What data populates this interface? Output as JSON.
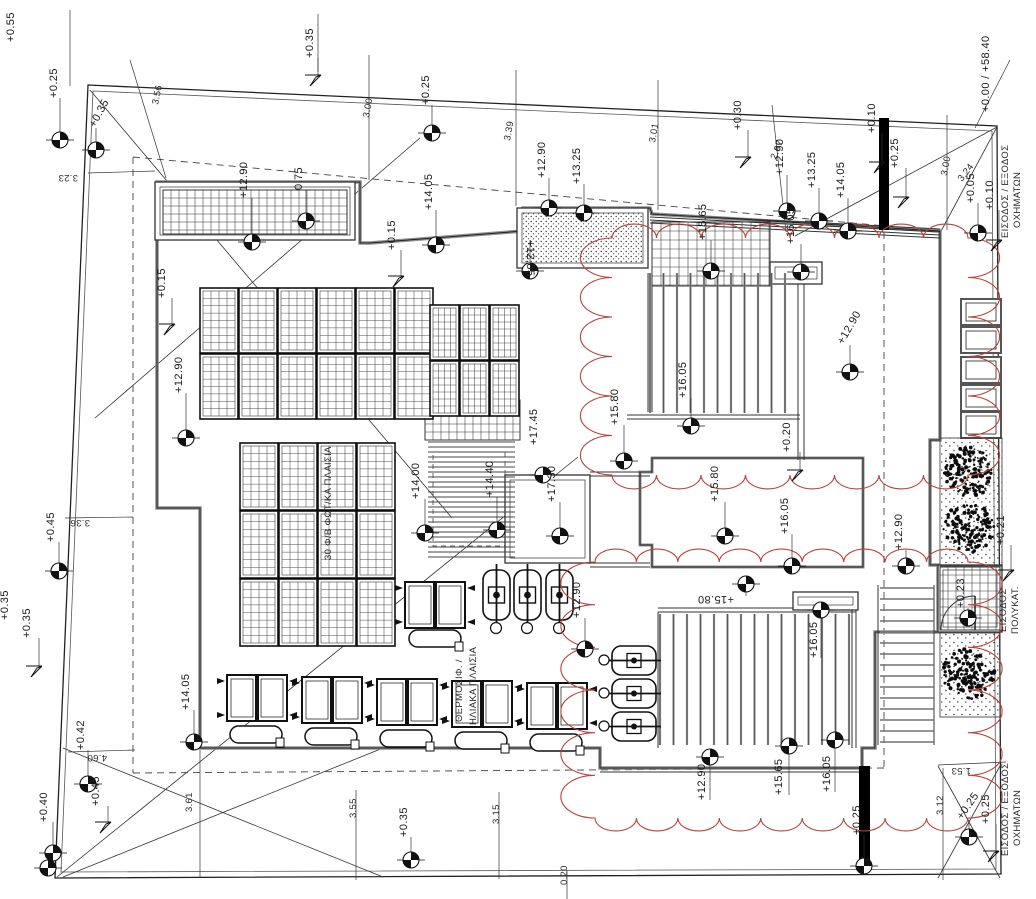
{
  "drawing": {
    "title": "roof plan with photovoltaic and solar heater layout",
    "width": 1036,
    "height": 899
  },
  "colors": {
    "line": "#222222",
    "wall": "#8f8f8f",
    "cloud_red": "#b5433b",
    "black_wall": "#000000",
    "dash": "#444444"
  },
  "boundary": {
    "outer": [
      [
        88,
        85
      ],
      [
        997,
        126
      ],
      [
        1001,
        874
      ],
      [
        55,
        878
      ]
    ],
    "inner": [
      [
        93,
        91
      ],
      [
        992,
        131
      ],
      [
        996,
        869
      ],
      [
        61,
        872
      ]
    ]
  },
  "corner_diagonals": [
    [
      90,
      90,
      452,
      518
    ],
    [
      95,
      418,
      420,
      138
    ],
    [
      63,
      748,
      383,
      877
    ],
    [
      63,
      877,
      383,
      748
    ],
    [
      57,
      877,
      578,
      457
    ],
    [
      938,
      766,
      1000,
      878
    ],
    [
      938,
      878,
      1000,
      766
    ],
    [
      997,
      127,
      940,
      233
    ],
    [
      997,
      127,
      795,
      236
    ]
  ],
  "dashed_segs": [
    [
      133,
      157,
      940,
      231
    ],
    [
      133,
      157,
      133,
      773
    ],
    [
      133,
      773,
      884,
      768
    ],
    [
      884,
      232,
      884,
      768
    ]
  ],
  "dashed_rects": [
    [
      433,
      452,
      72,
      94
    ]
  ],
  "dim_lines": [
    [
      130,
      60,
      166,
      178
    ],
    [
      369,
      55,
      369,
      180
    ],
    [
      516,
      70,
      516,
      206
    ],
    [
      658,
      80,
      658,
      210
    ],
    [
      772,
      105,
      786,
      232
    ],
    [
      947,
      115,
      947,
      230
    ],
    [
      88,
      173,
      155,
      171
    ],
    [
      65,
      518,
      133,
      517
    ],
    [
      68,
      752,
      135,
      750
    ],
    [
      200,
      750,
      200,
      878
    ],
    [
      356,
      790,
      356,
      880
    ],
    [
      499,
      792,
      499,
      879
    ],
    [
      567,
      870,
      567,
      899
    ],
    [
      943,
      768,
      943,
      880
    ],
    [
      938,
      765,
      1006,
      762
    ],
    [
      975,
      128,
      1010,
      60
    ],
    [
      318,
      14,
      318,
      72
    ],
    [
      70,
      10,
      70,
      86
    ]
  ],
  "building_path": "M157,182 L360,182 L360,243 L370,243 L523,231 L523,208 L650,208 L652,214 L940,231 L940,440 L930,440 L930,565 L938,565 L938,632 L875,632 L875,748 L862,748 L862,768 L600,768 L600,748 L200,748 L200,508 L157,508 Z",
  "roof_path": "M652,458 L863,458 L863,567 L652,567 L652,545 L640,545 L640,472 L652,472 Z",
  "wall_segs": [
    [
      590,
      472,
      650,
      472
    ],
    [
      590,
      476,
      650,
      476
    ],
    [
      590,
      563,
      650,
      563
    ],
    [
      590,
      567,
      650,
      567
    ],
    [
      648,
      273,
      648,
      412
    ],
    [
      652,
      273,
      652,
      412
    ],
    [
      798,
      268,
      798,
      460
    ],
    [
      804,
      268,
      804,
      460
    ],
    [
      627,
      415,
      800,
      415
    ],
    [
      627,
      419,
      800,
      419
    ],
    [
      658,
      608,
      856,
      608
    ],
    [
      658,
      612,
      856,
      612
    ],
    [
      658,
      612,
      658,
      748
    ],
    [
      852,
      596,
      852,
      748
    ],
    [
      856,
      596,
      856,
      748
    ],
    [
      878,
      585,
      878,
      745
    ],
    [
      934,
      585,
      934,
      745
    ],
    [
      600,
      772,
      862,
      772
    ]
  ],
  "multilines": [
    {
      "x1": 650,
      "y1": 214,
      "x2": 940,
      "y2": 229,
      "n": 4,
      "off": 3
    }
  ],
  "black_walls": [
    [
      879,
      118,
      10,
      112
    ],
    [
      859,
      766,
      11,
      102
    ]
  ],
  "dboxes": [
    [
      155,
      182,
      200,
      58
    ],
    [
      517,
      208,
      131,
      60
    ],
    [
      770,
      262,
      52,
      22
    ],
    [
      793,
      592,
      65,
      18
    ],
    [
      505,
      475,
      85,
      88
    ],
    [
      938,
      565,
      64,
      67
    ]
  ],
  "stipple_box_index": 1,
  "grids": [
    {
      "x": 163,
      "y": 190,
      "w": 184,
      "h": 44,
      "c": 8
    },
    {
      "x": 652,
      "y": 222,
      "w": 118,
      "h": 64,
      "c": 9
    },
    {
      "x": 425,
      "y": 400,
      "w": 95,
      "h": 40,
      "c": 8
    },
    {
      "x": 940,
      "y": 567,
      "w": 60,
      "h": 63,
      "c": 8
    }
  ],
  "pv_arrays": [
    {
      "x": 200,
      "y": 288,
      "cols": 6,
      "rows": 2,
      "pw": 38,
      "ph": 65
    },
    {
      "x": 430,
      "y": 305,
      "cols": 3,
      "rows": 2,
      "pw": 29,
      "ph": 55
    },
    {
      "x": 240,
      "y": 443,
      "cols": 4,
      "rows": 3,
      "pw": 38,
      "ph": 67
    }
  ],
  "louvres": [
    {
      "x": 650,
      "y": 273,
      "w": 140,
      "h": 140,
      "dir": "v",
      "gap": 13.5
    },
    {
      "x": 660,
      "y": 614,
      "w": 192,
      "h": 131,
      "dir": "v",
      "gap": 13.5
    },
    {
      "x": 428,
      "y": 442,
      "w": 87,
      "h": 118,
      "dir": "h",
      "gap": 5
    },
    {
      "x": 880,
      "y": 588,
      "w": 54,
      "h": 157,
      "dir": "h",
      "gap": 11
    }
  ],
  "clouds": [
    {
      "x": 612,
      "y": 238,
      "w": 356,
      "h": 237
    },
    {
      "x": 595,
      "y": 562,
      "w": 373,
      "h": 256
    }
  ],
  "planters": [
    [
      961,
      299,
      40,
      26
    ],
    [
      961,
      327,
      40,
      26
    ],
    [
      961,
      357,
      40,
      26
    ],
    [
      961,
      385,
      40,
      26
    ],
    [
      961,
      412,
      40,
      26
    ]
  ],
  "veg_beds": [
    [
      940,
      438,
      62,
      128
    ],
    [
      940,
      633,
      60,
      84
    ]
  ],
  "trees": [
    [
      969,
      472,
      26
    ],
    [
      969,
      528,
      26
    ],
    [
      968,
      674,
      27
    ]
  ],
  "collector_pairs": [
    [
      227,
      675
    ],
    [
      302,
      677
    ],
    [
      377,
      679
    ],
    [
      452,
      681
    ],
    [
      527,
      683
    ],
    [
      405,
      582
    ]
  ],
  "collector_pair_size": [
    60,
    46
  ],
  "tanks": [
    [
      230,
      726
    ],
    [
      305,
      728
    ],
    [
      380,
      730
    ],
    [
      455,
      732
    ],
    [
      530,
      734
    ],
    [
      409,
      630
    ]
  ],
  "tank_size": [
    52,
    17
  ],
  "vheaters": [
    [
      483,
      570
    ],
    [
      514,
      570
    ],
    [
      546,
      570
    ]
  ],
  "vheater_size": [
    27,
    50
  ],
  "vheater_circles": [
    [
      496,
      628
    ],
    [
      527,
      628
    ],
    [
      559,
      628
    ]
  ],
  "hheaters": [
    [
      612,
      646
    ],
    [
      612,
      679
    ],
    [
      612,
      712
    ]
  ],
  "hheater_size": [
    44,
    29
  ],
  "hheater_circles": [
    [
      604,
      660
    ],
    [
      604,
      693
    ],
    [
      604,
      726
    ]
  ],
  "door": {
    "cx": 975,
    "cy": 630,
    "r": 34
  },
  "standalone_markers": [
    [
      48,
      868
    ],
    [
      543,
      475
    ]
  ],
  "labels": [
    {
      "t": "+0.55",
      "x": 14,
      "y": 42,
      "r": -90,
      "k": "elev"
    },
    {
      "t": "+0.25",
      "x": 57,
      "y": 98,
      "r": -90,
      "k": "elev",
      "m": [
        60,
        140
      ]
    },
    {
      "t": "+0.35",
      "x": 95,
      "y": 128,
      "r": -62,
      "k": "elev",
      "m": [
        96,
        150
      ]
    },
    {
      "t": "+0.35",
      "x": 313,
      "y": 58,
      "r": -90,
      "k": "elev",
      "f": [
        318,
        75
      ]
    },
    {
      "t": "+0.25",
      "x": 429,
      "y": 105,
      "r": -90,
      "k": "elev",
      "m": [
        432,
        133
      ]
    },
    {
      "t": "+0.30",
      "x": 741,
      "y": 130,
      "r": -90,
      "k": "elev",
      "f": [
        748,
        157
      ]
    },
    {
      "t": "+0.10",
      "x": 875,
      "y": 133,
      "r": -90,
      "k": "elev",
      "f": [
        882,
        162
      ]
    },
    {
      "t": "+0.25",
      "x": 898,
      "y": 168,
      "r": -90,
      "k": "elev",
      "f": [
        906,
        197
      ]
    },
    {
      "t": "+0.00 / +58.40",
      "x": 989,
      "y": 112,
      "r": -90,
      "k": "elev"
    },
    {
      "t": "+0.05",
      "x": 974,
      "y": 203,
      "r": -90,
      "k": "elev",
      "m": [
        978,
        233
      ]
    },
    {
      "t": "+0.10",
      "x": 993,
      "y": 210,
      "r": -90,
      "k": "elev",
      "f": [
        999,
        240
      ]
    },
    {
      "t": "+12.90",
      "x": 247,
      "y": 198,
      "r": -90,
      "k": "elev",
      "m": [
        252,
        242
      ]
    },
    {
      "t": "0.75",
      "x": 302,
      "y": 190,
      "r": -90,
      "k": "elev",
      "m": [
        306,
        221
      ]
    },
    {
      "t": "+0.15",
      "x": 165,
      "y": 298,
      "r": -90,
      "k": "elev",
      "f": [
        172,
        324
      ]
    },
    {
      "t": "+12.90",
      "x": 182,
      "y": 393,
      "r": -90,
      "k": "elev",
      "m": [
        186,
        438
      ]
    },
    {
      "t": "+14.05",
      "x": 432,
      "y": 210,
      "r": -90,
      "k": "elev",
      "m": [
        436,
        245
      ]
    },
    {
      "t": "+0.15",
      "x": 395,
      "y": 250,
      "r": -90,
      "k": "elev",
      "f": [
        401,
        276
      ]
    },
    {
      "t": "+12.90",
      "x": 545,
      "y": 178,
      "r": -90,
      "k": "elev",
      "m": [
        549,
        208
      ]
    },
    {
      "t": "+13.25",
      "x": 580,
      "y": 184,
      "r": -90,
      "k": "elev",
      "m": [
        584,
        213
      ]
    },
    {
      "t": "+12.85",
      "x": 527,
      "y": 240,
      "r": 90,
      "k": "elev",
      "m": [
        530,
        271
      ]
    },
    {
      "t": "+12.90",
      "x": 783,
      "y": 175,
      "r": -90,
      "k": "elev",
      "m": [
        787,
        211
      ]
    },
    {
      "t": "+13.25",
      "x": 815,
      "y": 188,
      "r": -90,
      "k": "elev",
      "m": [
        819,
        221
      ]
    },
    {
      "t": "+14.05",
      "x": 844,
      "y": 198,
      "r": -90,
      "k": "elev",
      "m": [
        848,
        231
      ]
    },
    {
      "t": "+15.65",
      "x": 706,
      "y": 240,
      "r": -90,
      "k": "elev",
      "m": [
        711,
        271
      ]
    },
    {
      "t": "+16.05",
      "x": 794,
      "y": 244,
      "r": -90,
      "k": "elev",
      "m": [
        801,
        272
      ]
    },
    {
      "t": "+16.05",
      "x": 686,
      "y": 398,
      "r": -90,
      "k": "elev",
      "m": [
        691,
        426
      ]
    },
    {
      "t": "+12.90",
      "x": 843,
      "y": 345,
      "r": -60,
      "k": "elev",
      "m": [
        850,
        372
      ]
    },
    {
      "t": "+15.80",
      "x": 618,
      "y": 425,
      "r": -90,
      "k": "elev",
      "m": [
        624,
        461
      ]
    },
    {
      "t": "+17.45",
      "x": 537,
      "y": 445,
      "r": -90,
      "k": "elev"
    },
    {
      "t": "+17.30",
      "x": 555,
      "y": 502,
      "r": -90,
      "k": "elev",
      "m": [
        560,
        536
      ]
    },
    {
      "t": "+14.00",
      "x": 419,
      "y": 499,
      "r": -90,
      "k": "elev",
      "m": [
        425,
        533
      ]
    },
    {
      "t": "+14.40",
      "x": 493,
      "y": 497,
      "r": -90,
      "k": "elev",
      "m": [
        497,
        530
      ]
    },
    {
      "t": "+15.80",
      "x": 718,
      "y": 502,
      "r": -90,
      "k": "elev",
      "m": [
        725,
        536
      ]
    },
    {
      "t": "+16.05",
      "x": 788,
      "y": 534,
      "r": -90,
      "k": "elev",
      "m": [
        792,
        566
      ]
    },
    {
      "t": "+15.80",
      "x": 734,
      "y": 596,
      "r": 180,
      "k": "elev",
      "m": [
        746,
        584
      ]
    },
    {
      "t": "+0.20",
      "x": 790,
      "y": 452,
      "r": -90,
      "k": "elev",
      "f": [
        800,
        470
      ]
    },
    {
      "t": "+12.90",
      "x": 580,
      "y": 618,
      "r": -90,
      "k": "elev",
      "m": [
        585,
        649
      ]
    },
    {
      "t": "+16.05",
      "x": 817,
      "y": 658,
      "r": -90,
      "k": "elev",
      "m": [
        821,
        610
      ]
    },
    {
      "t": "+12.90",
      "x": 705,
      "y": 800,
      "r": -90,
      "k": "elev",
      "m": [
        710,
        757
      ]
    },
    {
      "t": "+15.65",
      "x": 782,
      "y": 795,
      "r": -90,
      "k": "elev",
      "m": [
        789,
        746
      ]
    },
    {
      "t": "+16.05",
      "x": 830,
      "y": 792,
      "r": -90,
      "k": "elev",
      "m": [
        835,
        740
      ]
    },
    {
      "t": "+12.90",
      "x": 902,
      "y": 550,
      "r": -90,
      "k": "elev",
      "m": [
        906,
        566
      ]
    },
    {
      "t": "+0.21",
      "x": 1004,
      "y": 545,
      "r": -90,
      "k": "elev",
      "f": [
        1011,
        570
      ]
    },
    {
      "t": "+0.23",
      "x": 964,
      "y": 608,
      "r": -90,
      "k": "elev",
      "m": [
        968,
        618
      ]
    },
    {
      "t": "+0.25",
      "x": 962,
      "y": 820,
      "r": -55,
      "k": "elev",
      "m": [
        969,
        837
      ]
    },
    {
      "t": "+0.25",
      "x": 989,
      "y": 824,
      "r": -90,
      "k": "elev",
      "f": [
        996,
        851
      ]
    },
    {
      "t": "+0.25",
      "x": 860,
      "y": 835,
      "r": -90,
      "k": "elev",
      "m": [
        864,
        866
      ]
    },
    {
      "t": "+0.35",
      "x": 8,
      "y": 620,
      "r": -90,
      "k": "elev"
    },
    {
      "t": "+0.45",
      "x": 54,
      "y": 542,
      "r": -90,
      "k": "elev",
      "m": [
        59,
        571
      ]
    },
    {
      "t": "+0.35",
      "x": 30,
      "y": 638,
      "r": -90,
      "k": "elev",
      "f": [
        39,
        666
      ]
    },
    {
      "t": "+0.42",
      "x": 84,
      "y": 750,
      "r": -90,
      "k": "elev",
      "m": [
        88,
        784
      ]
    },
    {
      "t": "+0.45",
      "x": 99,
      "y": 806,
      "r": -90,
      "k": "elev",
      "f": [
        108,
        822
      ]
    },
    {
      "t": "+0.40",
      "x": 47,
      "y": 822,
      "r": -90,
      "k": "elev",
      "m": [
        53,
        853
      ]
    },
    {
      "t": "+0.35",
      "x": 407,
      "y": 837,
      "r": -90,
      "k": "elev",
      "m": [
        411,
        860
      ]
    },
    {
      "t": "+14.05",
      "x": 189,
      "y": 710,
      "r": -90,
      "k": "elev",
      "m": [
        194,
        742
      ]
    },
    {
      "t": "3.56",
      "x": 158,
      "y": 105,
      "r": -78,
      "k": "dim"
    },
    {
      "t": "3.23",
      "x": 78,
      "y": 175,
      "r": 180,
      "k": "dim"
    },
    {
      "t": "3.00",
      "x": 369,
      "y": 118,
      "r": -80,
      "k": "dim"
    },
    {
      "t": "3.39",
      "x": 510,
      "y": 141,
      "r": -80,
      "k": "dim"
    },
    {
      "t": "3.01",
      "x": 655,
      "y": 143,
      "r": -80,
      "k": "dim"
    },
    {
      "t": "2.97",
      "x": 776,
      "y": 160,
      "r": -68,
      "k": "dim"
    },
    {
      "t": "3.00",
      "x": 947,
      "y": 176,
      "r": -80,
      "k": "dim"
    },
    {
      "t": "3.24",
      "x": 962,
      "y": 182,
      "r": -52,
      "k": "dim"
    },
    {
      "t": "3.36",
      "x": 90,
      "y": 520,
      "r": 180,
      "k": "dim"
    },
    {
      "t": "4.60",
      "x": 107,
      "y": 755,
      "r": 180,
      "k": "dim"
    },
    {
      "t": "3.61",
      "x": 192,
      "y": 812,
      "r": -90,
      "k": "dim"
    },
    {
      "t": "3.55",
      "x": 356,
      "y": 818,
      "r": -90,
      "k": "dim"
    },
    {
      "t": "3.15",
      "x": 499,
      "y": 824,
      "r": -90,
      "k": "dim"
    },
    {
      "t": "3.12",
      "x": 943,
      "y": 815,
      "r": -90,
      "k": "dim"
    },
    {
      "t": "1.53",
      "x": 971,
      "y": 768,
      "r": 180,
      "k": "dim"
    },
    {
      "t": "0.20",
      "x": 567,
      "y": 885,
      "r": -90,
      "k": "dim"
    },
    {
      "t": "ΕΙΣΟΔΟΣ / ΕΞΟΔΟΣ",
      "x": 1008,
      "y": 238,
      "r": -90,
      "k": "greek"
    },
    {
      "t": "ΟΧΗΜΑΤΩΝ",
      "x": 1020,
      "y": 228,
      "r": -90,
      "k": "greek"
    },
    {
      "t": "ΕΙΣΟΔΟΣ",
      "x": 1006,
      "y": 632,
      "r": -90,
      "k": "greek"
    },
    {
      "t": "ΠΟΛΥΚΑΤ.",
      "x": 1018,
      "y": 634,
      "r": -90,
      "k": "greek"
    },
    {
      "t": "ΕΙΣΟΔΟΣ / ΕΞΟΔΟΣ",
      "x": 1008,
      "y": 856,
      "r": -90,
      "k": "greek"
    },
    {
      "t": "ΟΧΗΜΑΤΩΝ",
      "x": 1020,
      "y": 846,
      "r": -90,
      "k": "greek"
    },
    {
      "t": "ΘΕΡΜΟΣΙΦ. /",
      "x": 462,
      "y": 722,
      "r": -90,
      "k": "greek"
    },
    {
      "t": "ΗΛΙΑΚΑ ΠΛΑΙΣΙΑ",
      "x": 476,
      "y": 725,
      "r": -90,
      "k": "greek"
    },
    {
      "t": "30 Φ/Β ΦΩΤ/ΚΑ ΠΛΑΙΣΙΑ",
      "x": 331,
      "y": 560,
      "r": -90,
      "k": "greek"
    }
  ]
}
